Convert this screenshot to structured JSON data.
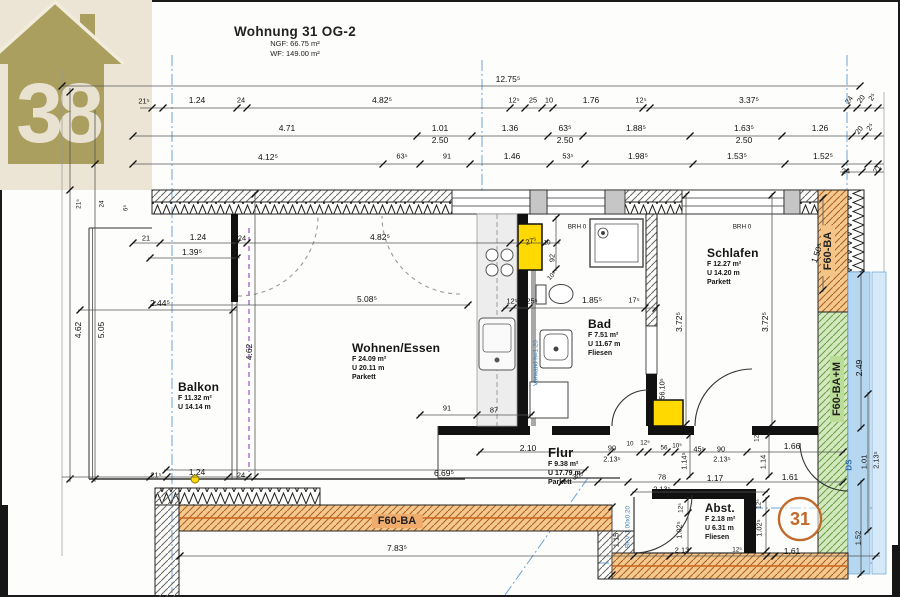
{
  "header": {
    "title": "Wohnung 31 OG-2",
    "ngf": "NGF: 66.75 m²",
    "wf": "WF: 149.00 m²"
  },
  "logo": {
    "number": "38"
  },
  "badge": {
    "number": "31"
  },
  "fire": {
    "bottom": "F60-BA",
    "right_top": "F60-BA",
    "right_bottom": "F60-BA+M"
  },
  "colors": {
    "highlight_yellow": "#ffd900",
    "fire_orange_label": "#f0ac6c",
    "fire_green_label": "#b9dc96",
    "stair_blue": "#b5d7f0",
    "refline_blue": "#6aa3d8",
    "badge_orange": "#c0692a",
    "wall_hatch_orange": "#f3c98f",
    "wall_hatch_green": "#d4e8c0",
    "logo_olive": "#ab9f60"
  },
  "rooms": [
    {
      "name": "Balkon",
      "lines": [
        "F 11.32 m²",
        "U 14.14 m"
      ],
      "x": 178,
      "y": 380,
      "size": 12
    },
    {
      "name": "Wohnen/Essen",
      "lines": [
        "F 24.09 m²",
        "U 20.11 m",
        "Parkett"
      ],
      "x": 352,
      "y": 341,
      "size": 12
    },
    {
      "name": "Bad",
      "lines": [
        "F 7.51 m²",
        "U 11.67 m",
        "Fliesen"
      ],
      "x": 588,
      "y": 317,
      "size": 12
    },
    {
      "name": "Schlafen",
      "lines": [
        "F 12.27 m²",
        "U 14.20 m",
        "Parkett"
      ],
      "x": 707,
      "y": 246,
      "size": 12
    },
    {
      "name": "Flur",
      "lines": [
        "F 9.38 m²",
        "U 17.79 m",
        "Parkett"
      ],
      "x": 548,
      "y": 445,
      "size": 13
    },
    {
      "name": "Abst.",
      "lines": [
        "F 2.18 m²",
        "U 6.31 m",
        "Fliesen"
      ],
      "x": 705,
      "y": 503,
      "size": 11.5
    }
  ],
  "dimension_labels": [
    {
      "t": "12.75⁵",
      "x": 508,
      "y": 79
    },
    {
      "t": "21⁵",
      "x": 144,
      "y": 101,
      "c": "s"
    },
    {
      "t": "1.24",
      "x": 197,
      "y": 100
    },
    {
      "t": "24",
      "x": 241,
      "y": 100,
      "c": "s"
    },
    {
      "t": "4.82⁵",
      "x": 382,
      "y": 100
    },
    {
      "t": "12⁵",
      "x": 514,
      "y": 100,
      "c": "s"
    },
    {
      "t": "25",
      "x": 533,
      "y": 100,
      "c": "s"
    },
    {
      "t": "10",
      "x": 549,
      "y": 100,
      "c": "s"
    },
    {
      "t": "1.76",
      "x": 591,
      "y": 100
    },
    {
      "t": "12⁵",
      "x": 641,
      "y": 100,
      "c": "s"
    },
    {
      "t": "3.37⁵",
      "x": 749,
      "y": 100
    },
    {
      "t": "24",
      "x": 849,
      "y": 100,
      "c": "s",
      "r": -55
    },
    {
      "t": "20",
      "x": 861,
      "y": 99,
      "c": "s",
      "r": -55
    },
    {
      "t": "2⁵",
      "x": 872,
      "y": 97,
      "c": "s",
      "r": -55
    },
    {
      "t": "4.71",
      "x": 287,
      "y": 128
    },
    {
      "t": "1.01",
      "x": 440,
      "y": 128
    },
    {
      "t": "2.50",
      "x": 440,
      "y": 140
    },
    {
      "t": "1.36",
      "x": 510,
      "y": 128
    },
    {
      "t": "63⁵",
      "x": 565,
      "y": 128
    },
    {
      "t": "2.50",
      "x": 565,
      "y": 140
    },
    {
      "t": "1.88⁵",
      "x": 636,
      "y": 128
    },
    {
      "t": "1.63⁵",
      "x": 744,
      "y": 128
    },
    {
      "t": "2.50",
      "x": 744,
      "y": 140
    },
    {
      "t": "1.26",
      "x": 820,
      "y": 128
    },
    {
      "t": "20",
      "x": 859,
      "y": 130,
      "c": "s",
      "r": -55
    },
    {
      "t": "2⁵",
      "x": 870,
      "y": 127,
      "c": "s",
      "r": -55
    },
    {
      "t": "4.12⁵",
      "x": 268,
      "y": 157
    },
    {
      "t": "63⁵",
      "x": 402,
      "y": 156,
      "c": "s"
    },
    {
      "t": "91",
      "x": 447,
      "y": 156,
      "c": "s"
    },
    {
      "t": "1.46",
      "x": 512,
      "y": 156
    },
    {
      "t": "53⁵",
      "x": 568,
      "y": 156,
      "c": "s"
    },
    {
      "t": "1.98⁵",
      "x": 638,
      "y": 156
    },
    {
      "t": "1.53⁵",
      "x": 737,
      "y": 156
    },
    {
      "t": "1.52⁵",
      "x": 823,
      "y": 156
    },
    {
      "t": "24",
      "x": 846,
      "y": 171,
      "c": "s"
    },
    {
      "t": "21",
      "x": 877,
      "y": 169,
      "c": "s",
      "r": -55
    },
    {
      "t": "4.62",
      "x": 78,
      "y": 330,
      "r": -90
    },
    {
      "t": "5.05",
      "x": 101,
      "y": 330,
      "r": -90
    },
    {
      "t": "21⁵",
      "x": 79,
      "y": 204,
      "r": -90,
      "c": "t"
    },
    {
      "t": "24",
      "x": 102,
      "y": 204,
      "r": -90,
      "c": "t"
    },
    {
      "t": "6⁵",
      "x": 126,
      "y": 208,
      "r": -90,
      "c": "t"
    },
    {
      "t": "21⁵",
      "x": 156,
      "y": 475,
      "c": "s"
    },
    {
      "t": "1.24",
      "x": 197,
      "y": 472
    },
    {
      "t": "24",
      "x": 241,
      "y": 475,
      "c": "s"
    },
    {
      "t": "21",
      "x": 146,
      "y": 238,
      "c": "s"
    },
    {
      "t": "1.24",
      "x": 198,
      "y": 237
    },
    {
      "t": "24",
      "x": 242,
      "y": 238,
      "c": "s"
    },
    {
      "t": "4.82⁵",
      "x": 380,
      "y": 237
    },
    {
      "t": "1.39⁵",
      "x": 192,
      "y": 252
    },
    {
      "t": "2.44⁵",
      "x": 160,
      "y": 303
    },
    {
      "t": "5.08⁵",
      "x": 367,
      "y": 299
    },
    {
      "t": "12⁵",
      "x": 512,
      "y": 301,
      "c": "s"
    },
    {
      "t": "25⁵",
      "x": 532,
      "y": 301,
      "c": "s"
    },
    {
      "t": "1.85⁵",
      "x": 592,
      "y": 300
    },
    {
      "t": "17⁵",
      "x": 634,
      "y": 300,
      "c": "s"
    },
    {
      "t": "27⁵",
      "x": 531,
      "y": 241,
      "r": -15,
      "c": "s"
    },
    {
      "t": "10",
      "x": 547,
      "y": 243,
      "c": "t"
    },
    {
      "t": "92",
      "x": 552,
      "y": 258,
      "r": -90,
      "c": "s"
    },
    {
      "t": "10⁵",
      "x": 552,
      "y": 276,
      "r": -45,
      "c": "t"
    },
    {
      "t": "BRH 0",
      "x": 577,
      "y": 227,
      "c": "t"
    },
    {
      "t": "BRH 0",
      "x": 742,
      "y": 227,
      "c": "t"
    },
    {
      "t": "Vorwand h=1.20",
      "x": 536,
      "y": 363,
      "r": -90,
      "c": "bt"
    },
    {
      "t": "3.72⁵",
      "x": 679,
      "y": 322,
      "r": -90
    },
    {
      "t": "3.72⁵",
      "x": 765,
      "y": 322,
      "r": -90
    },
    {
      "t": "4.62",
      "x": 249,
      "y": 352,
      "r": -90
    },
    {
      "t": "1.50⁵",
      "x": 817,
      "y": 253,
      "r": -70
    },
    {
      "t": "56.10⁵",
      "x": 662,
      "y": 389,
      "r": -90,
      "c": "s"
    },
    {
      "t": "91",
      "x": 447,
      "y": 408,
      "c": "s"
    },
    {
      "t": "87",
      "x": 494,
      "y": 410,
      "c": "s"
    },
    {
      "t": "6.69⁵",
      "x": 444,
      "y": 473
    },
    {
      "t": "2.10",
      "x": 528,
      "y": 448
    },
    {
      "t": "90",
      "x": 612,
      "y": 448,
      "c": "s"
    },
    {
      "t": "2.13⁵",
      "x": 612,
      "y": 459,
      "c": "s"
    },
    {
      "t": "10",
      "x": 630,
      "y": 444,
      "c": "t"
    },
    {
      "t": "12⁵",
      "x": 645,
      "y": 443,
      "c": "t"
    },
    {
      "t": "56",
      "x": 664,
      "y": 448,
      "c": "t"
    },
    {
      "t": "10⁵",
      "x": 677,
      "y": 446,
      "c": "t"
    },
    {
      "t": "45⁵",
      "x": 699,
      "y": 449,
      "c": "s"
    },
    {
      "t": "90",
      "x": 721,
      "y": 449,
      "c": "s"
    },
    {
      "t": "2.13⁵",
      "x": 722,
      "y": 459,
      "c": "s"
    },
    {
      "t": "1.66",
      "x": 792,
      "y": 446
    },
    {
      "t": "1.14⁵",
      "x": 684,
      "y": 461,
      "r": -90,
      "c": "s"
    },
    {
      "t": "1.14",
      "x": 763,
      "y": 462,
      "r": -90,
      "c": "s"
    },
    {
      "t": "12⁵",
      "x": 757,
      "y": 437,
      "r": -90,
      "c": "t"
    },
    {
      "t": "30⁵",
      "x": 578,
      "y": 476,
      "c": "s",
      "r": -15
    },
    {
      "t": "78",
      "x": 662,
      "y": 477,
      "c": "s"
    },
    {
      "t": "2.13⁵",
      "x": 662,
      "y": 489,
      "c": "s"
    },
    {
      "t": "1.17",
      "x": 715,
      "y": 478
    },
    {
      "t": "1.61",
      "x": 790,
      "y": 477
    },
    {
      "t": "12⁵",
      "x": 681,
      "y": 508,
      "r": -90,
      "c": "t"
    },
    {
      "t": "1.02⁵",
      "x": 679,
      "y": 530,
      "r": -90,
      "c": "s"
    },
    {
      "t": "12⁵",
      "x": 759,
      "y": 504,
      "r": -90,
      "c": "t"
    },
    {
      "t": "1.02⁵",
      "x": 759,
      "y": 528,
      "r": -90,
      "c": "s"
    },
    {
      "t": "2.13",
      "x": 682,
      "y": 550,
      "c": "s"
    },
    {
      "t": "12⁵",
      "x": 737,
      "y": 550,
      "c": "t"
    },
    {
      "t": "BKV 1.00x0.20",
      "x": 628,
      "y": 527,
      "r": -90,
      "c": "bt"
    },
    {
      "t": "F60-BA",
      "x": 397,
      "y": 521,
      "c": "hidden-placeholder"
    },
    {
      "t": "7.83⁵",
      "x": 397,
      "y": 548
    },
    {
      "t": "1.15",
      "x": 616,
      "y": 540,
      "r": -90,
      "c": "s"
    },
    {
      "t": "1.61",
      "x": 792,
      "y": 551
    },
    {
      "t": "1.52",
      "x": 858,
      "y": 538,
      "r": -90,
      "c": "s"
    },
    {
      "t": "2.49",
      "x": 859,
      "y": 368,
      "r": -90
    },
    {
      "t": "DS",
      "x": 849,
      "y": 465,
      "r": -90,
      "c": "bl"
    },
    {
      "t": "1.01",
      "x": 864,
      "y": 462,
      "r": -90,
      "c": "s"
    },
    {
      "t": "2.13⁵",
      "x": 876,
      "y": 460,
      "r": -90,
      "c": "s"
    }
  ]
}
